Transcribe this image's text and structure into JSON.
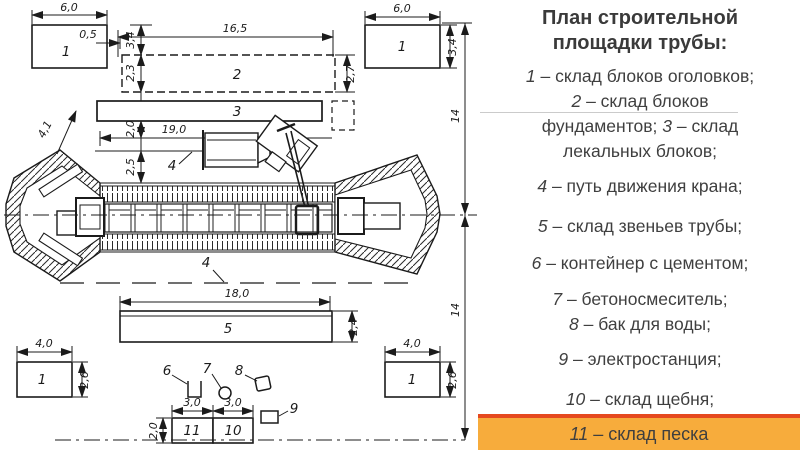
{
  "panel": {
    "title_line1": "План строительной",
    "title_line2": "площадки трубы:",
    "legend": [
      {
        "num": "1",
        "text": "– склад блоков оголовков;"
      },
      {
        "num": "2",
        "text": "– склад блоков фундаментов;"
      },
      {
        "num": "3",
        "text": "– склад лекальных блоков;"
      },
      {
        "num": "4",
        "text": "– путь движения крана;"
      },
      {
        "num": "5",
        "text": "– склад звеньев трубы;"
      },
      {
        "num": "6",
        "text": "– контейнер с цементом;"
      },
      {
        "num": "7",
        "text": "– бетоносмеситель;"
      },
      {
        "num": "8",
        "text": "– бак для воды;"
      },
      {
        "num": "9",
        "text": "– электростанция;"
      },
      {
        "num": "10",
        "text": "– склад щебня;"
      },
      {
        "num": "11",
        "text": "– склад песка"
      }
    ],
    "colors": {
      "band_bg": "#F7AC3C",
      "band_border": "#E5491F",
      "text": "#3F3F3F"
    }
  },
  "drawing": {
    "dims": {
      "d6_0": "6,0",
      "d0_5": "0,5",
      "d16_5": "16,5",
      "d3_4": "3,4",
      "d2_3": "2,3",
      "d1_6": "1,6",
      "d2_0": "2,0",
      "d2_5": "2,5",
      "d2_7": "2,7",
      "d19_0": "19,0",
      "d4_1": "4,1",
      "d14": "14",
      "d18_0": "18,0",
      "d2_4": "2,4",
      "d4_0": "4,0",
      "d2_6": "2,6",
      "d3_0": "3,0"
    },
    "marks": {
      "m1": "1",
      "m2": "2",
      "m3": "3",
      "m4": "4",
      "m5": "5",
      "m6": "6",
      "m7": "7",
      "m8": "8",
      "m9": "9",
      "m10": "10",
      "m11": "11"
    }
  }
}
